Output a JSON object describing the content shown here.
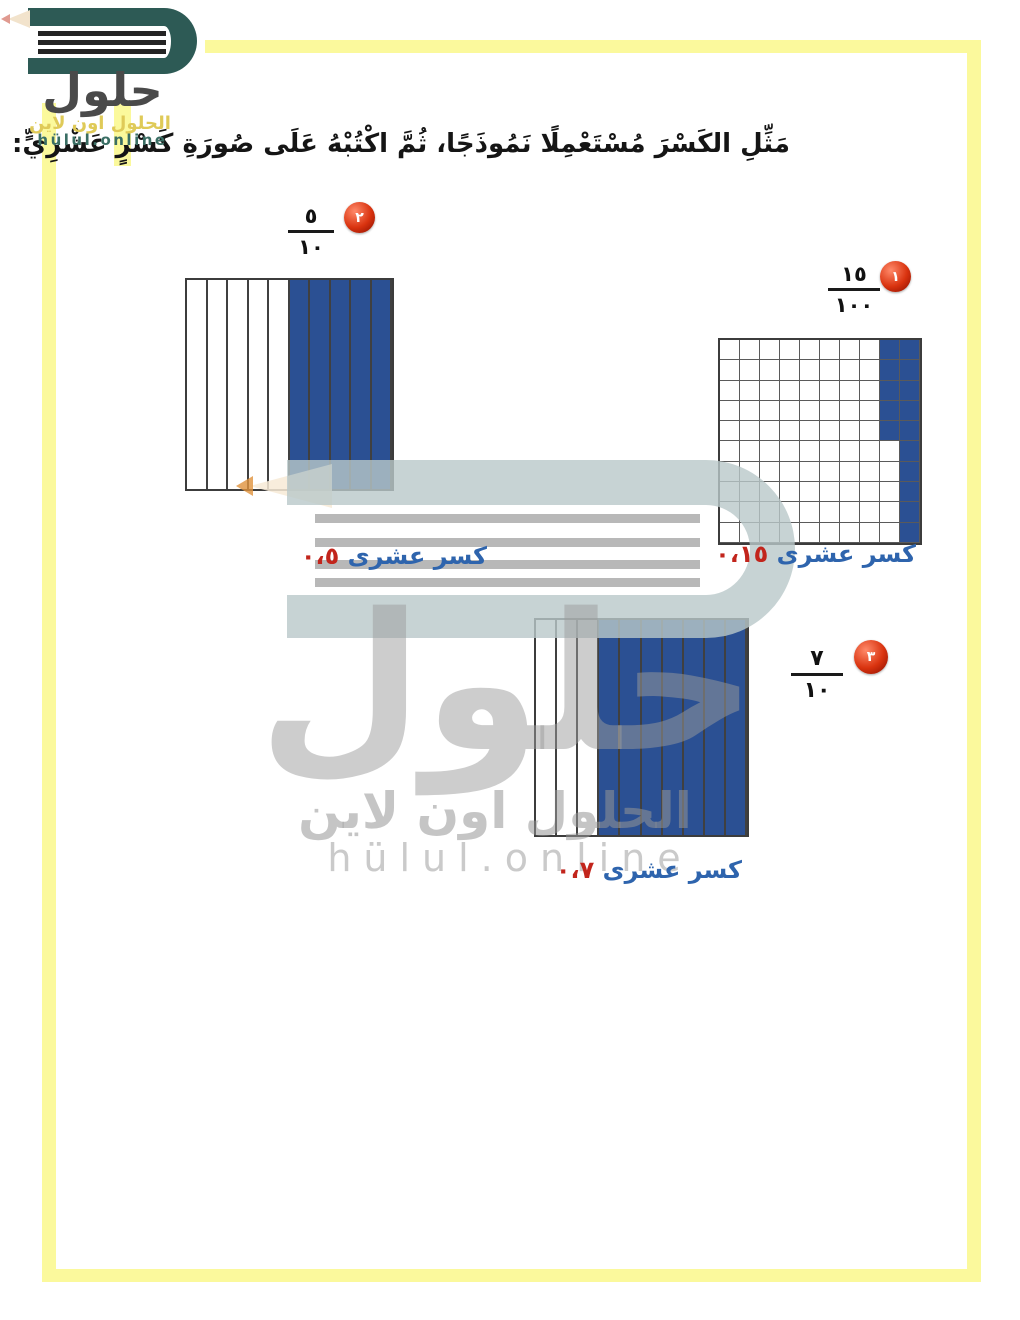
{
  "instruction": "مَثِّلِ الكَسْرَ مُسْتَعْمِلًا نَمُوذَجًا، ثُمَّ اكْتُبْهُ عَلَى صُورَةِ كَسْرٍ عَشْرِيٍّ:",
  "logo": {
    "brand_arabic": "حلول",
    "tagline_arabic": "الحلول اون لاين",
    "domain": "hülul.online"
  },
  "watermark": {
    "brand_arabic": "حلول",
    "tagline_arabic": "الحلول اون لاين",
    "domain": "hülul.online"
  },
  "problems": [
    {
      "number": "١",
      "fraction": {
        "numerator": "١٥",
        "denominator": "١٠٠"
      },
      "model": {
        "type": "hundred-grid",
        "rows": 10,
        "cols": 10,
        "full_shaded_right_cols": 1,
        "partial_shaded_next_col_top_cells": 5,
        "shaded_total": 15,
        "shaded_side": "right"
      },
      "answer": {
        "label": "كسر عشرى",
        "value": "٠،١٥"
      }
    },
    {
      "number": "٢",
      "fraction": {
        "numerator": "٥",
        "denominator": "١٠"
      },
      "model": {
        "type": "tenths-bar",
        "cols": 10,
        "shaded_cols": 5,
        "shaded_side": "right"
      },
      "answer": {
        "label": "كسر عشرى",
        "value": "٠،٥"
      }
    },
    {
      "number": "٣",
      "fraction": {
        "numerator": "٧",
        "denominator": "١٠"
      },
      "model": {
        "type": "tenths-bar",
        "cols": 10,
        "shaded_cols": 7,
        "shaded_side": "right"
      },
      "answer": {
        "label": "كسر عشرى",
        "value": "٠،٧"
      }
    }
  ],
  "colors": {
    "frame_yellow": "#fbf99c",
    "model_shaded_blue": "#2b5093",
    "answer_label_blue": "#2e64ad",
    "answer_value_red": "#c2251c",
    "badge_red": "#d9330f",
    "logo_teal": "#2d5a55",
    "logo_text_gray": "#4a4a4a",
    "logo_tagline_yellow": "#dfca58",
    "logo_domain_teal": "#3a6e64"
  }
}
